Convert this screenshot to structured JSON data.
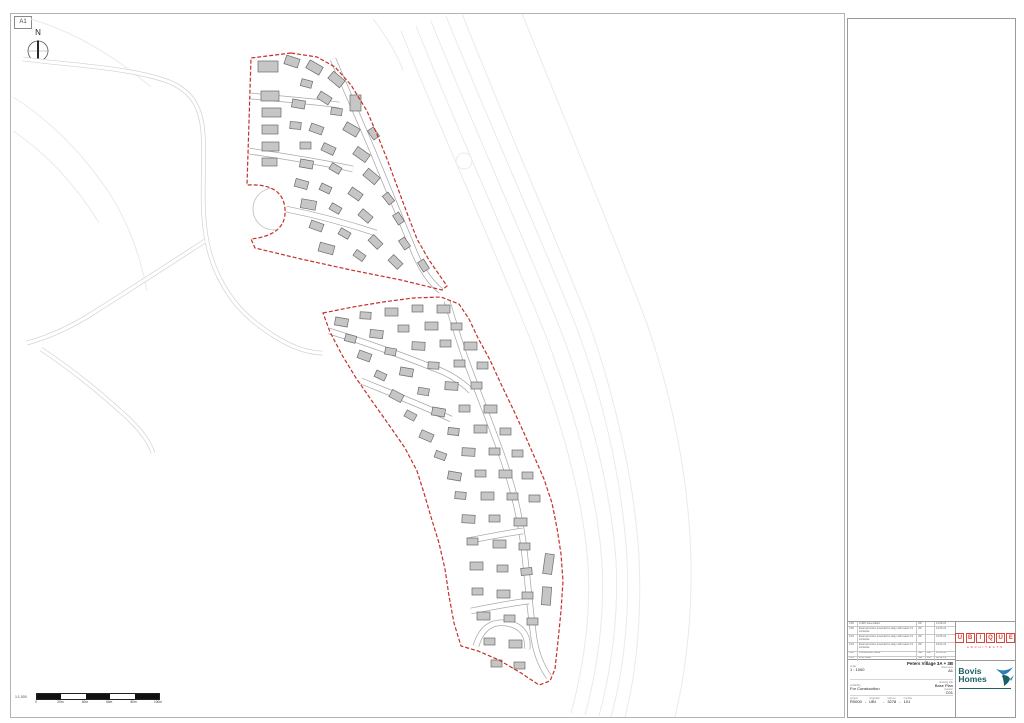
{
  "colors": {
    "boundary_red": "#c2312b",
    "building_fill": "#c6c6c6",
    "building_stroke": "#6b6b6b",
    "contour": "#eaeaea",
    "ext_road_casing": "#d2d2d2",
    "int_road_casing": "#a9a9a9",
    "ubique_red": "#d8453a",
    "bovis_teal": "#1c5f66"
  },
  "sheet": {
    "size_label": "A1",
    "north_label": "N"
  },
  "scale_bar": {
    "label": "1:1,000",
    "tick_labels": [
      "0",
      "20m",
      "40m",
      "60m",
      "80m",
      "100m"
    ],
    "segments": 5
  },
  "title_block": {
    "revision_table": {
      "rows": [
        [
          "C06",
          "LURP area added",
          "JW",
          "",
          "21.08.24"
        ],
        [
          "C05",
          "External works amended to align with latest C3 schedule",
          "JW",
          "",
          "14.06.24"
        ],
        [
          "C04",
          "External works amended to align with latest C3 schedule",
          "JW",
          "",
          "31.05.24"
        ],
        [
          "C03",
          "External works amended to align with latest C3 schedule",
          "JW",
          "",
          "19.04.24"
        ],
        [
          "C02",
          "Construction issue",
          "NW",
          "AH",
          "12.01.24"
        ],
        [
          "C01",
          "First issue",
          "NW",
          "AH",
          "08.12.23"
        ]
      ]
    },
    "project_title": "Peters Village 3A + 3B",
    "fields": {
      "scale_label": "scale",
      "scale": "1 : 1000",
      "sheet_label": "sheet size",
      "sheet": "A1",
      "drawing_label": "drawing title",
      "drawing": "Base Plan",
      "suitability_label": "suitability",
      "suitability": "For Construction",
      "revision_label": "revision",
      "revision": "C01"
    },
    "number": {
      "labels": [
        "project",
        "originator",
        "volume",
        "number"
      ],
      "values": [
        "R0000",
        "UBI",
        "3278",
        "101"
      ]
    },
    "ubique": {
      "name": "UBIQUE",
      "sub": "ARCHITECTS"
    },
    "bovis": {
      "line1": "Bovis",
      "line2": "Homes"
    }
  },
  "plan": {
    "contours": [
      "M 430 20 C 470 120 520 230 560 330 C 590 410 610 490 615 560 C 618 615 610 670 598 715",
      "M 445 15 C 485 115 535 225 575 325 C 605 405 622 488 626 558 C 629 615 622 672 610 716",
      "M 460 10 C 500 112 548 220 588 322 C 616 402 634 486 638 556 C 641 614 635 674 624 716",
      "M 415 25 C 455 125 505 235 545 335 C 575 415 596 492 601 562 C 604 616 596 670 584 714",
      "M 400 30 C 440 130 490 240 530 340 C 560 420 582 494 587 564 C 590 617 582 668 570 712",
      "M 520 10 C 560 110 605 215 645 320 C 672 398 688 480 690 560 C 691 620 684 675 674 716",
      "M 12 96 C 50 120 85 155 112 198 C 130 228 140 258 146 290",
      "M 12 130 C 45 152 75 184 98 222",
      "M 30 18 C 70 30 110 52 150 86",
      "M 372 18 C 385 35 396 52 402 70"
    ],
    "faint_circles": [
      {
        "cx": 463,
        "cy": 160,
        "r": 8
      }
    ],
    "ext_roads": [
      "M 22 58 C 70 64 120 66 160 78 C 190 87 200 105 202 132 C 204 162 200 196 204 228 C 207 252 214 272 227 292 C 240 312 258 326 278 338 C 295 348 310 352 322 352",
      "M 204 240 C 170 262 130 288 92 312 C 70 326 48 336 26 342",
      "M 40 348 C 70 368 100 392 128 418 C 140 430 148 440 152 452"
    ],
    "culdesac": {
      "cx": 273,
      "cy": 208,
      "r": 21
    },
    "parcels": [
      "M 290 52 L 250 57 L 246 184 Q 282 182 284 208 Q 286 234 250 238 L 254 247 L 300 258 L 350 269 L 400 279 L 441 289 L 446 285 L 428 259 L 416 238 L 406 212 L 396 185 L 386 158 L 378 138 L 366 110 L 350 84 L 334 66 L 316 56 Z",
      "M 322 312 L 352 306 L 382 301 L 412 297 L 440 296 L 458 303 L 468 318 L 477 337 L 489 359 L 500 383 L 512 408 L 523 432 L 533 455 L 543 478 L 551 502 L 556 527 L 560 553 L 562 580 L 560 610 L 557 640 L 554 668 L 549 680 L 538 684 L 520 672 L 498 659 L 477 650 L 460 645 L 453 622 L 448 595 L 444 568 L 438 542 L 430 516 L 423 492 L 416 470 L 404 447 L 388 424 L 371 400 L 355 377 L 341 354 L 329 331 Z"
    ],
    "int_roads": [
      "M 332 58 C 344 86 356 114 370 146 C 384 180 398 214 412 248 C 420 268 430 282 440 290",
      "M 250 95 C 280 98 310 100 338 104",
      "M 248 150 C 280 155 315 160 352 168",
      "M 285 208 C 315 214 345 222 375 232",
      "M 446 300 C 452 320 458 340 466 362 C 478 394 490 424 500 452 C 510 480 518 510 522 540 C 526 570 528 600 532 630 C 534 650 540 665 548 676",
      "M 328 330 C 360 340 395 352 430 366 C 448 372 460 380 470 390",
      "M 360 380 C 390 392 420 404 450 418",
      "M 466 540 C 486 536 506 532 522 530",
      "M 470 610 C 490 606 510 602 528 600",
      "M 475 645 C 480 628 490 620 505 622 C 520 624 528 634 526 648"
    ],
    "buildings": [
      [
        257,
        60,
        20,
        11,
        0
      ],
      [
        284,
        56,
        14,
        9,
        18
      ],
      [
        306,
        62,
        15,
        9,
        30
      ],
      [
        328,
        74,
        15,
        9,
        40
      ],
      [
        300,
        79,
        11,
        7,
        15
      ],
      [
        260,
        90,
        18,
        10,
        0
      ],
      [
        261,
        107,
        19,
        9,
        0
      ],
      [
        291,
        99,
        13,
        8,
        10
      ],
      [
        317,
        93,
        13,
        8,
        32
      ],
      [
        349,
        94,
        11,
        16,
        0
      ],
      [
        330,
        107,
        11,
        7,
        8
      ],
      [
        261,
        124,
        16,
        9,
        0
      ],
      [
        289,
        121,
        11,
        7,
        5
      ],
      [
        309,
        124,
        13,
        8,
        20
      ],
      [
        343,
        124,
        15,
        9,
        30
      ],
      [
        367,
        129,
        11,
        7,
        55
      ],
      [
        261,
        141,
        17,
        9,
        0
      ],
      [
        299,
        141,
        11,
        7,
        0
      ],
      [
        321,
        144,
        13,
        8,
        25
      ],
      [
        353,
        149,
        15,
        9,
        35
      ],
      [
        261,
        157,
        15,
        8,
        0
      ],
      [
        299,
        159,
        13,
        8,
        10
      ],
      [
        329,
        164,
        11,
        7,
        30
      ],
      [
        363,
        171,
        15,
        9,
        40
      ],
      [
        294,
        179,
        13,
        8,
        15
      ],
      [
        319,
        184,
        11,
        7,
        25
      ],
      [
        348,
        189,
        13,
        8,
        35
      ],
      [
        382,
        194,
        11,
        7,
        52
      ],
      [
        300,
        199,
        15,
        9,
        10
      ],
      [
        329,
        204,
        11,
        7,
        30
      ],
      [
        358,
        211,
        13,
        8,
        40
      ],
      [
        392,
        214,
        11,
        7,
        58
      ],
      [
        309,
        221,
        13,
        8,
        20
      ],
      [
        338,
        229,
        11,
        7,
        30
      ],
      [
        368,
        237,
        13,
        8,
        45
      ],
      [
        398,
        239,
        11,
        7,
        55
      ],
      [
        318,
        243,
        15,
        9,
        15
      ],
      [
        353,
        251,
        11,
        7,
        35
      ],
      [
        388,
        257,
        13,
        8,
        45
      ],
      [
        417,
        261,
        11,
        7,
        58
      ],
      [
        334,
        317,
        13,
        8,
        10
      ],
      [
        359,
        311,
        11,
        7,
        3
      ],
      [
        384,
        307,
        13,
        8,
        0
      ],
      [
        411,
        304,
        11,
        7,
        0
      ],
      [
        436,
        304,
        13,
        8,
        0
      ],
      [
        344,
        334,
        11,
        7,
        15
      ],
      [
        369,
        329,
        13,
        8,
        6
      ],
      [
        397,
        324,
        11,
        7,
        0
      ],
      [
        424,
        321,
        13,
        8,
        0
      ],
      [
        450,
        322,
        11,
        7,
        0
      ],
      [
        357,
        351,
        13,
        8,
        20
      ],
      [
        384,
        347,
        11,
        7,
        10
      ],
      [
        411,
        341,
        13,
        8,
        3
      ],
      [
        439,
        339,
        11,
        7,
        0
      ],
      [
        463,
        341,
        13,
        8,
        0
      ],
      [
        374,
        371,
        11,
        7,
        25
      ],
      [
        399,
        367,
        13,
        8,
        10
      ],
      [
        427,
        361,
        11,
        7,
        3
      ],
      [
        453,
        359,
        11,
        7,
        0
      ],
      [
        476,
        361,
        11,
        7,
        0
      ],
      [
        389,
        391,
        13,
        8,
        28
      ],
      [
        417,
        387,
        11,
        7,
        10
      ],
      [
        444,
        381,
        13,
        8,
        3
      ],
      [
        470,
        381,
        11,
        7,
        0
      ],
      [
        404,
        411,
        11,
        7,
        28
      ],
      [
        431,
        407,
        13,
        8,
        10
      ],
      [
        458,
        404,
        11,
        7,
        0
      ],
      [
        483,
        404,
        13,
        8,
        0
      ],
      [
        419,
        431,
        13,
        8,
        24
      ],
      [
        447,
        427,
        11,
        7,
        6
      ],
      [
        473,
        424,
        13,
        8,
        0
      ],
      [
        499,
        427,
        11,
        7,
        0
      ],
      [
        434,
        451,
        11,
        7,
        20
      ],
      [
        461,
        447,
        13,
        8,
        3
      ],
      [
        488,
        447,
        11,
        7,
        0
      ],
      [
        511,
        449,
        11,
        7,
        0
      ],
      [
        447,
        471,
        13,
        8,
        10
      ],
      [
        474,
        469,
        11,
        7,
        0
      ],
      [
        498,
        469,
        13,
        8,
        0
      ],
      [
        521,
        471,
        11,
        7,
        0
      ],
      [
        454,
        491,
        11,
        7,
        5
      ],
      [
        480,
        491,
        13,
        8,
        0
      ],
      [
        506,
        492,
        11,
        7,
        0
      ],
      [
        528,
        494,
        11,
        7,
        0
      ],
      [
        461,
        514,
        13,
        8,
        3
      ],
      [
        488,
        514,
        11,
        7,
        0
      ],
      [
        513,
        517,
        13,
        8,
        0
      ],
      [
        466,
        537,
        11,
        7,
        0
      ],
      [
        492,
        539,
        13,
        8,
        0
      ],
      [
        518,
        542,
        11,
        7,
        0
      ],
      [
        469,
        561,
        13,
        8,
        0
      ],
      [
        496,
        564,
        11,
        7,
        0
      ],
      [
        520,
        567,
        11,
        7,
        355
      ],
      [
        471,
        587,
        11,
        7,
        0
      ],
      [
        496,
        589,
        13,
        8,
        0
      ],
      [
        521,
        591,
        11,
        7,
        0
      ],
      [
        476,
        611,
        13,
        8,
        0
      ],
      [
        503,
        614,
        11,
        7,
        0
      ],
      [
        526,
        617,
        11,
        7,
        0
      ],
      [
        483,
        637,
        11,
        7,
        0
      ],
      [
        508,
        639,
        13,
        8,
        0
      ],
      [
        490,
        659,
        11,
        7,
        0
      ],
      [
        513,
        661,
        11,
        7,
        0
      ],
      [
        543,
        553,
        9,
        20,
        8
      ],
      [
        541,
        586,
        9,
        18,
        4
      ]
    ]
  }
}
